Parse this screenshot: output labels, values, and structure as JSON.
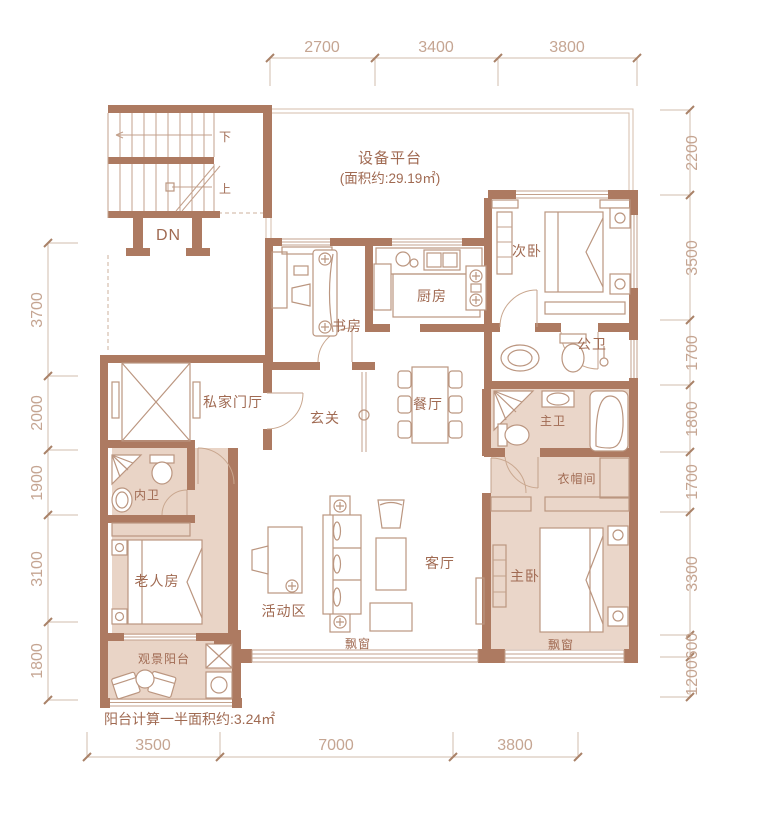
{
  "colors": {
    "wall": "#ad7a61",
    "floor_shade": "#ead6c9",
    "line": "#bb9680",
    "label_text": "#a06a52",
    "dimension_text": "#c5a592",
    "background": "#ffffff"
  },
  "labels": {
    "equipment_platform": "设备平台",
    "equipment_platform_area": "(面积约:29.19㎡)",
    "secondary_bedroom": "次卧",
    "study": "书房",
    "kitchen": "厨房",
    "public_bathroom": "公卫",
    "private_foyer": "私家门厅",
    "entryway": "玄关",
    "dining_room": "餐厅",
    "master_bathroom": "主卫",
    "inner_bathroom": "内卫",
    "cloakroom": "衣帽间",
    "elder_room": "老人房",
    "activity_zone": "活动区",
    "living_room": "客厅",
    "master_bedroom": "主卧",
    "view_balcony": "观景阳台",
    "bay_window_living": "飘窗",
    "bay_window_master": "飘窗",
    "stairs_down": "下",
    "stairs_up": "上",
    "stairs_dn": "DN",
    "balcony_note": "阳台计算一半面积约:3.24㎡"
  },
  "dimensions": {
    "top": [
      "2700",
      "3400",
      "3800"
    ],
    "bottom": [
      "3500",
      "7000",
      "3800"
    ],
    "left": [
      "3700",
      "2000",
      "1900",
      "3100",
      "1800"
    ],
    "right": [
      "2200",
      "3500",
      "1700",
      "1800",
      "1700",
      "3300",
      "600",
      "1200"
    ]
  }
}
